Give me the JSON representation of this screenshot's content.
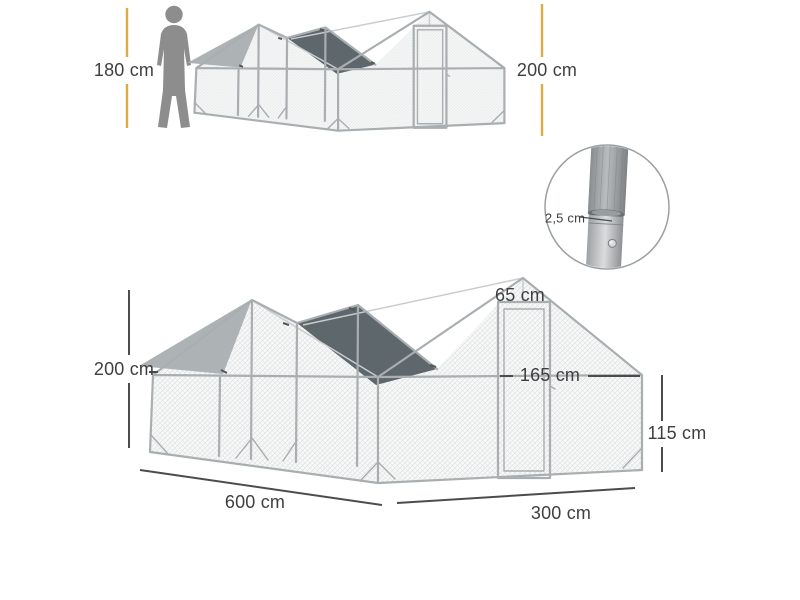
{
  "diagram": {
    "person": {
      "height_label": "180 cm"
    },
    "top_view": {
      "height_label": "200 cm"
    },
    "detail_inset": {
      "tube_diameter_label": "2,5 cm"
    },
    "main_view": {
      "ridge_height_label": "200 cm",
      "door_width_label": "65 cm",
      "door_height_label": "165 cm",
      "side_height_label": "115 cm",
      "length_label": "600 cm",
      "depth_label": "300 cm"
    }
  },
  "colors": {
    "accent_yellow": "#dcab43",
    "tarp_light": "#adb2b5",
    "tarp_dark": "#5d676c",
    "frame_gray": "#a9aeb1",
    "dimension_line": "#4c4c4c",
    "label_text": "#3f3f3f",
    "silhouette_gray": "#8d8d8d",
    "mesh_line": "#d9dcdd"
  }
}
